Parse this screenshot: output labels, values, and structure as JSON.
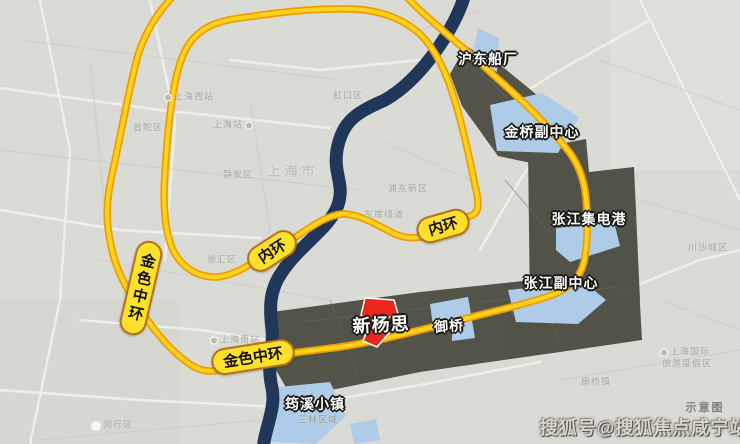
{
  "colors": {
    "background": "#DBDBD6",
    "river": "#20375A",
    "road_fill": "#FFD21E",
    "road_casing": "#EE9E00",
    "badge_fill": "#FFE12B",
    "badge_border": "#B4731B",
    "zone_dark": "#4B4A40",
    "water_highlight": "#AECBE8",
    "project_red": "#E8281E"
  },
  "road_badges": [
    {
      "id": "inner-ring-left",
      "label": "内环"
    },
    {
      "id": "inner-ring-right",
      "label": "内环"
    },
    {
      "id": "golden-ring-west",
      "label": "金色中环"
    },
    {
      "id": "golden-ring-south",
      "label": "金色中环"
    }
  ],
  "zone_labels": [
    {
      "id": "hudong-shipyard",
      "label": "沪东船厂"
    },
    {
      "id": "jinqiao-subcenter",
      "label": "金桥副中心"
    },
    {
      "id": "zhangjiang-ic-port",
      "label": "张江集电港"
    },
    {
      "id": "zhangjiang-subcenter",
      "label": "张江副中心"
    },
    {
      "id": "yuqiao",
      "label": "御桥"
    },
    {
      "id": "yunxi-town",
      "label": "筠溪小镇"
    }
  ],
  "project": {
    "label": "新杨思"
  },
  "base_labels": [
    {
      "id": "putuo-district",
      "text": "普陀区"
    },
    {
      "id": "shanghai-west-station",
      "text": "上海西站"
    },
    {
      "id": "shanghai-station",
      "text": "上海站"
    },
    {
      "id": "shanghai-city",
      "text": "上海市"
    },
    {
      "id": "jingan-district",
      "text": "静安区"
    },
    {
      "id": "hongkou-district",
      "text": "虹口区"
    },
    {
      "id": "xuhui-district",
      "text": "徐汇区"
    },
    {
      "id": "shanghai-south-station",
      "text": "上海南站"
    },
    {
      "id": "minhang-district",
      "text": "闵行区"
    },
    {
      "id": "dongan-greenway",
      "text": "东岸绿道"
    },
    {
      "id": "pudong-new-area",
      "text": "浦东新区"
    },
    {
      "id": "sanlin-area",
      "text": "三林区域"
    },
    {
      "id": "chuansha-area",
      "text": "川沙城区"
    },
    {
      "id": "intl-resort-line1",
      "text": "上海国际"
    },
    {
      "id": "intl-resort-line2",
      "text": "旅游度假区"
    },
    {
      "id": "kangqiao-town",
      "text": "康桥镇"
    }
  ],
  "watermark": {
    "text": "搜狐号@搜狐焦点咸宁站"
  },
  "note": {
    "text": "示意图"
  }
}
